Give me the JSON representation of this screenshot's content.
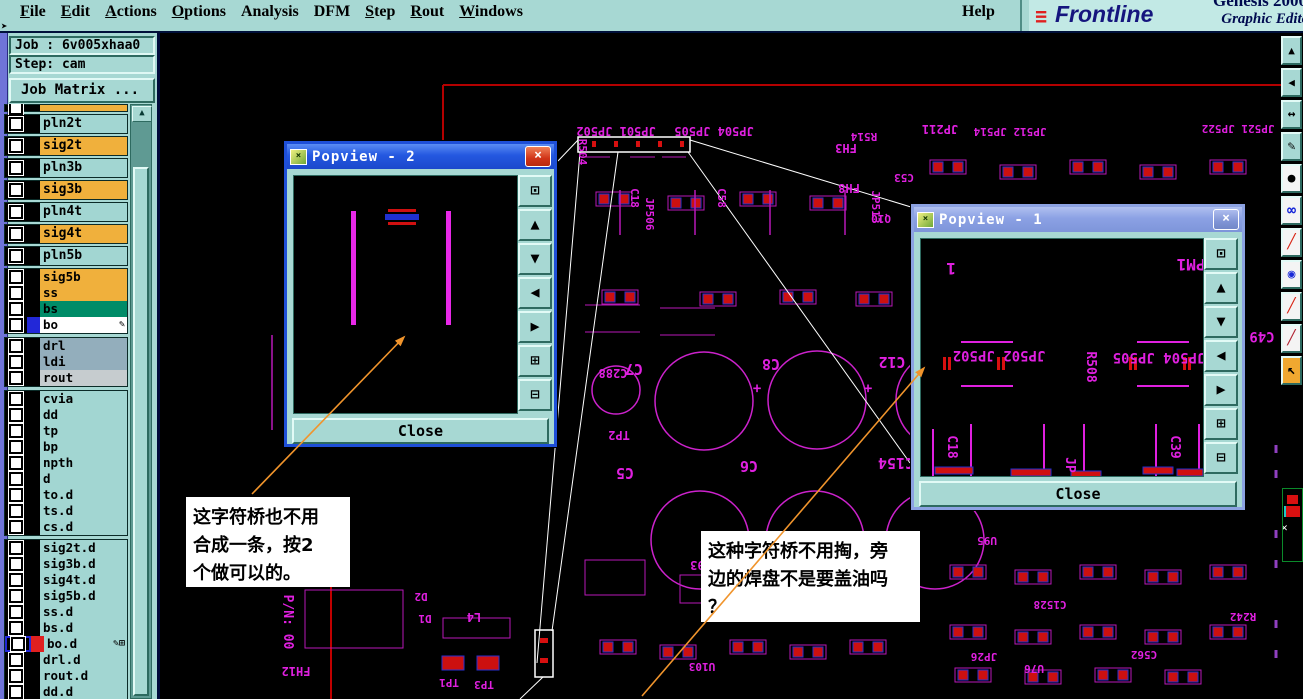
{
  "menu": {
    "items": [
      {
        "label": "File",
        "ul": 0
      },
      {
        "label": "Edit",
        "ul": 0
      },
      {
        "label": "Actions",
        "ul": 0
      },
      {
        "label": "Options",
        "ul": 0
      },
      {
        "label": "Analysis",
        "ul": -1
      },
      {
        "label": "DFM",
        "ul": -1
      },
      {
        "label": "Step",
        "ul": 0
      },
      {
        "label": "Rout",
        "ul": 0
      },
      {
        "label": "Windows",
        "ul": 0
      }
    ],
    "help": "Help"
  },
  "brand": {
    "logo_stripes": "≡",
    "logo": "Frontline",
    "product": "Genesis 2000",
    "tagline": "Graphic Editor"
  },
  "sidebar": {
    "job": "Job : 6v005xhaa0",
    "step": "Step: cam",
    "job_matrix": "Job Matrix ...",
    "scroll_up_icon": "▲",
    "layers": [
      {
        "name": "",
        "bg": "#f0b03c",
        "tall": 1,
        "partial": 1
      },
      {
        "name": "pln2t",
        "bg": "#a2d6d2",
        "tall": 1
      },
      {
        "name": "sig2t",
        "bg": "#f0b03c",
        "tall": 1
      },
      {
        "name": "pln3b",
        "bg": "#a2d6d2",
        "tall": 1
      },
      {
        "name": "sig3b",
        "bg": "#f0b03c",
        "tall": 1
      },
      {
        "name": "pln4t",
        "bg": "#a2d6d2",
        "tall": 1
      },
      {
        "name": "sig4t",
        "bg": "#f0b03c",
        "tall": 1
      },
      {
        "name": "pln5b",
        "bg": "#a2d6d2",
        "tall": 1
      },
      {
        "name": "sig5b",
        "bg": "#f0b03c",
        "grp": 1
      },
      {
        "name": "ss",
        "bg": "#f0b03c"
      },
      {
        "name": "bs",
        "bg": "#008c68"
      },
      {
        "name": "bo",
        "bg": "#ffffff",
        "chip": "#2228d8",
        "icons": "✎"
      },
      {
        "name": "drl",
        "bg": "#93aebc",
        "grp": 1
      },
      {
        "name": "ldi",
        "bg": "#93aebc"
      },
      {
        "name": "rout",
        "bg": "#c6cccf"
      },
      {
        "name": "cvia",
        "bg": "#a2d6d2",
        "grp": 1
      },
      {
        "name": "dd",
        "bg": "#a2d6d2"
      },
      {
        "name": "tp",
        "bg": "#a2d6d2"
      },
      {
        "name": "bp",
        "bg": "#a2d6d2"
      },
      {
        "name": "npth",
        "bg": "#a2d6d2"
      },
      {
        "name": "d",
        "bg": "#a2d6d2"
      },
      {
        "name": "to.d",
        "bg": "#a2d6d2"
      },
      {
        "name": "ts.d",
        "bg": "#a2d6d2"
      },
      {
        "name": "cs.d",
        "bg": "#a2d6d2"
      },
      {
        "name": "sig2t.d",
        "bg": "#a2d6d2",
        "grp": 1
      },
      {
        "name": "sig3b.d",
        "bg": "#a2d6d2"
      },
      {
        "name": "sig4t.d",
        "bg": "#a2d6d2"
      },
      {
        "name": "sig5b.d",
        "bg": "#a2d6d2"
      },
      {
        "name": "ss.d",
        "bg": "#a2d6d2"
      },
      {
        "name": "bs.d",
        "bg": "#a2d6d2"
      },
      {
        "name": "bo.d",
        "bg": "#a2d6d2",
        "chip": "#e02020",
        "cbBorder": "#2228d8",
        "icons": "✎⊞"
      },
      {
        "name": "drl.d",
        "bg": "#a2d6d2"
      },
      {
        "name": "rout.d",
        "bg": "#a2d6d2"
      },
      {
        "name": "dd.d",
        "bg": "#a2d6d2"
      },
      {
        "name": "1",
        "bg": "#a2d6d2"
      }
    ]
  },
  "popview2": {
    "title": "Popview - 2",
    "close": "Close",
    "window_icon": "×",
    "close_icon": "×"
  },
  "popview1": {
    "title": "Popview - 1",
    "close": "Close",
    "window_icon": "×",
    "close_icon": "×",
    "canvas_labels": [
      {
        "t": "1",
        "x": 30,
        "y": 24,
        "s": 16
      },
      {
        "t": "PM1",
        "x": 270,
        "y": 20,
        "s": 16
      },
      {
        "t": "JP502 JP502",
        "x": 78,
        "y": 112,
        "s": 14
      },
      {
        "t": "JP504 JP505",
        "x": 238,
        "y": 114,
        "s": 14
      },
      {
        "t": "R508",
        "x": 166,
        "y": 128,
        "v": 1,
        "s": 13
      },
      {
        "t": "C18",
        "x": 27,
        "y": 208,
        "v": 1,
        "s": 13
      },
      {
        "t": "JP",
        "x": 145,
        "y": 226,
        "v": 1,
        "s": 13
      },
      {
        "t": "C39",
        "x": 250,
        "y": 208,
        "v": 1,
        "s": 13
      }
    ]
  },
  "popview_buttons": [
    {
      "name": "open-popview-icon",
      "glyph": "⊡"
    },
    {
      "name": "pan-up-icon",
      "glyph": "▲"
    },
    {
      "name": "pan-down-icon",
      "glyph": "▼"
    },
    {
      "name": "pan-left-icon",
      "glyph": "◀"
    },
    {
      "name": "pan-right-icon",
      "glyph": "▶"
    },
    {
      "name": "zoom-in-icon",
      "glyph": "⊞"
    },
    {
      "name": "zoom-out-icon",
      "glyph": "⊟"
    }
  ],
  "toolbar": {
    "buttons": [
      {
        "name": "pan-up-icon",
        "glyph": "▲",
        "bg": "#a7d8d3",
        "fg": "#000",
        "size": 11
      },
      {
        "name": "pan-left-icon",
        "glyph": "◀",
        "bg": "#a7d8d3",
        "fg": "#000",
        "size": 11
      },
      {
        "name": "pan-horizontal-icon",
        "glyph": "↔",
        "bg": "#a7d8d3",
        "fg": "#000",
        "size": 13
      },
      {
        "name": "measure-pen-icon",
        "glyph": "✎",
        "bg": "#a7d8d3",
        "fg": "#000",
        "size": 13
      },
      {
        "name": "filled-circle-icon",
        "glyph": "●",
        "bg": "#f4f4f4",
        "fg": "#000",
        "size": 13
      },
      {
        "name": "net-dumbbell-icon",
        "glyph": "∞",
        "bg": "#f4f4f4",
        "fg": "#1828d8",
        "size": 15
      },
      {
        "name": "red-line-icon",
        "glyph": "╱",
        "bg": "#f4f4f4",
        "fg": "#d82010",
        "size": 14
      },
      {
        "name": "pad-select-icon",
        "glyph": "◉",
        "bg": "#f4f4f4",
        "fg": "#1828d8",
        "size": 13
      },
      {
        "name": "red-line-icon",
        "glyph": "╱",
        "bg": "#f4f4f4",
        "fg": "#d82010",
        "size": 14
      },
      {
        "name": "red-blue-line-icon",
        "glyph": "╱",
        "bg": "#f4f4f4",
        "fg": "#b02030",
        "size": 14
      },
      {
        "name": "select-cursor-icon",
        "glyph": "↖",
        "bg": "#f0a830",
        "fg": "#000",
        "size": 14
      }
    ]
  },
  "annotations": [
    {
      "text": "这字符桥也不用\n合成一条，按2\n个做可以的。"
    },
    {
      "text": "这种字符桥不用掏，旁\n边的焊盘不是要盖油吗\n？"
    }
  ],
  "pcb": {
    "labels": [
      {
        "t": "JP501 JP502",
        "x": 616,
        "y": 127,
        "s": 12
      },
      {
        "t": "JP504 JP505",
        "x": 714,
        "y": 127,
        "s": 12
      },
      {
        "t": "R504",
        "x": 579,
        "y": 152,
        "v": 1,
        "s": 11
      },
      {
        "t": "JP211",
        "x": 940,
        "y": 125,
        "s": 12
      },
      {
        "t": "JP512 JP514",
        "x": 1010,
        "y": 128,
        "s": 11
      },
      {
        "t": "JP521 JP522",
        "x": 1238,
        "y": 125,
        "s": 11
      },
      {
        "t": "R514",
        "x": 864,
        "y": 133,
        "s": 11
      },
      {
        "t": "FH3",
        "x": 846,
        "y": 144,
        "s": 12
      },
      {
        "t": "FH8",
        "x": 849,
        "y": 184,
        "s": 12
      },
      {
        "t": "JP513",
        "x": 872,
        "y": 207,
        "v": 1,
        "s": 11
      },
      {
        "t": "C53",
        "x": 904,
        "y": 174,
        "s": 11
      },
      {
        "t": "Q10",
        "x": 881,
        "y": 215,
        "s": 11
      },
      {
        "t": "C49",
        "x": 1262,
        "y": 332,
        "s": 14
      },
      {
        "t": "C18",
        "x": 631,
        "y": 198,
        "v": 1,
        "s": 11
      },
      {
        "t": "JP506",
        "x": 646,
        "y": 214,
        "v": 1,
        "s": 11
      },
      {
        "t": "C58",
        "x": 718,
        "y": 198,
        "v": 1,
        "s": 11
      },
      {
        "t": "C288",
        "x": 613,
        "y": 369,
        "s": 12
      },
      {
        "t": "TP2",
        "x": 619,
        "y": 431,
        "s": 12
      },
      {
        "t": "C7",
        "x": 634,
        "y": 364,
        "s": 15
      },
      {
        "t": "C8",
        "x": 771,
        "y": 359,
        "s": 15
      },
      {
        "t": "C12",
        "x": 892,
        "y": 357,
        "s": 15
      },
      {
        "t": "+",
        "x": 757,
        "y": 384,
        "s": 14
      },
      {
        "t": "+",
        "x": 868,
        "y": 384,
        "s": 14
      },
      {
        "t": "C5",
        "x": 625,
        "y": 468,
        "s": 15
      },
      {
        "t": "C6",
        "x": 749,
        "y": 461,
        "s": 15
      },
      {
        "t": "C154",
        "x": 896,
        "y": 458,
        "s": 15
      },
      {
        "t": "U93",
        "x": 701,
        "y": 561,
        "s": 12
      },
      {
        "t": "D2",
        "x": 421,
        "y": 593,
        "s": 11
      },
      {
        "t": "D1",
        "x": 425,
        "y": 615,
        "s": 11
      },
      {
        "t": "L4",
        "x": 474,
        "y": 613,
        "s": 12
      },
      {
        "t": "TP1",
        "x": 449,
        "y": 679,
        "s": 11
      },
      {
        "t": "TP3",
        "x": 484,
        "y": 681,
        "s": 11
      },
      {
        "t": "FH12",
        "x": 296,
        "y": 667,
        "s": 12
      },
      {
        "t": "P/N: 00",
        "x": 284,
        "y": 622,
        "v": 1,
        "s": 13
      },
      {
        "t": "C1528",
        "x": 1050,
        "y": 601,
        "s": 11
      },
      {
        "t": "U76",
        "x": 1034,
        "y": 665,
        "s": 11
      },
      {
        "t": "R242",
        "x": 1243,
        "y": 613,
        "s": 11
      },
      {
        "t": "C562",
        "x": 1144,
        "y": 651,
        "s": 11
      },
      {
        "t": "U95",
        "x": 987,
        "y": 537,
        "s": 11
      },
      {
        "t": "JP26",
        "x": 984,
        "y": 653,
        "s": 11
      },
      {
        "t": "U103",
        "x": 702,
        "y": 663,
        "s": 11
      },
      {
        "t": "C573",
        "x": 842,
        "y": 611,
        "s": 11
      }
    ]
  },
  "colors": {
    "chrome_teal": "#a7d8d3",
    "magenta": "#e020e0",
    "pad_red": "#cc1010",
    "pad_blue": "#2830d0",
    "board_red": "#b40000",
    "leader_white": "#ffffff",
    "arrow_orange": "#f0942c",
    "active_title": "#2458e0",
    "inactive_title": "#8ba1e4"
  }
}
